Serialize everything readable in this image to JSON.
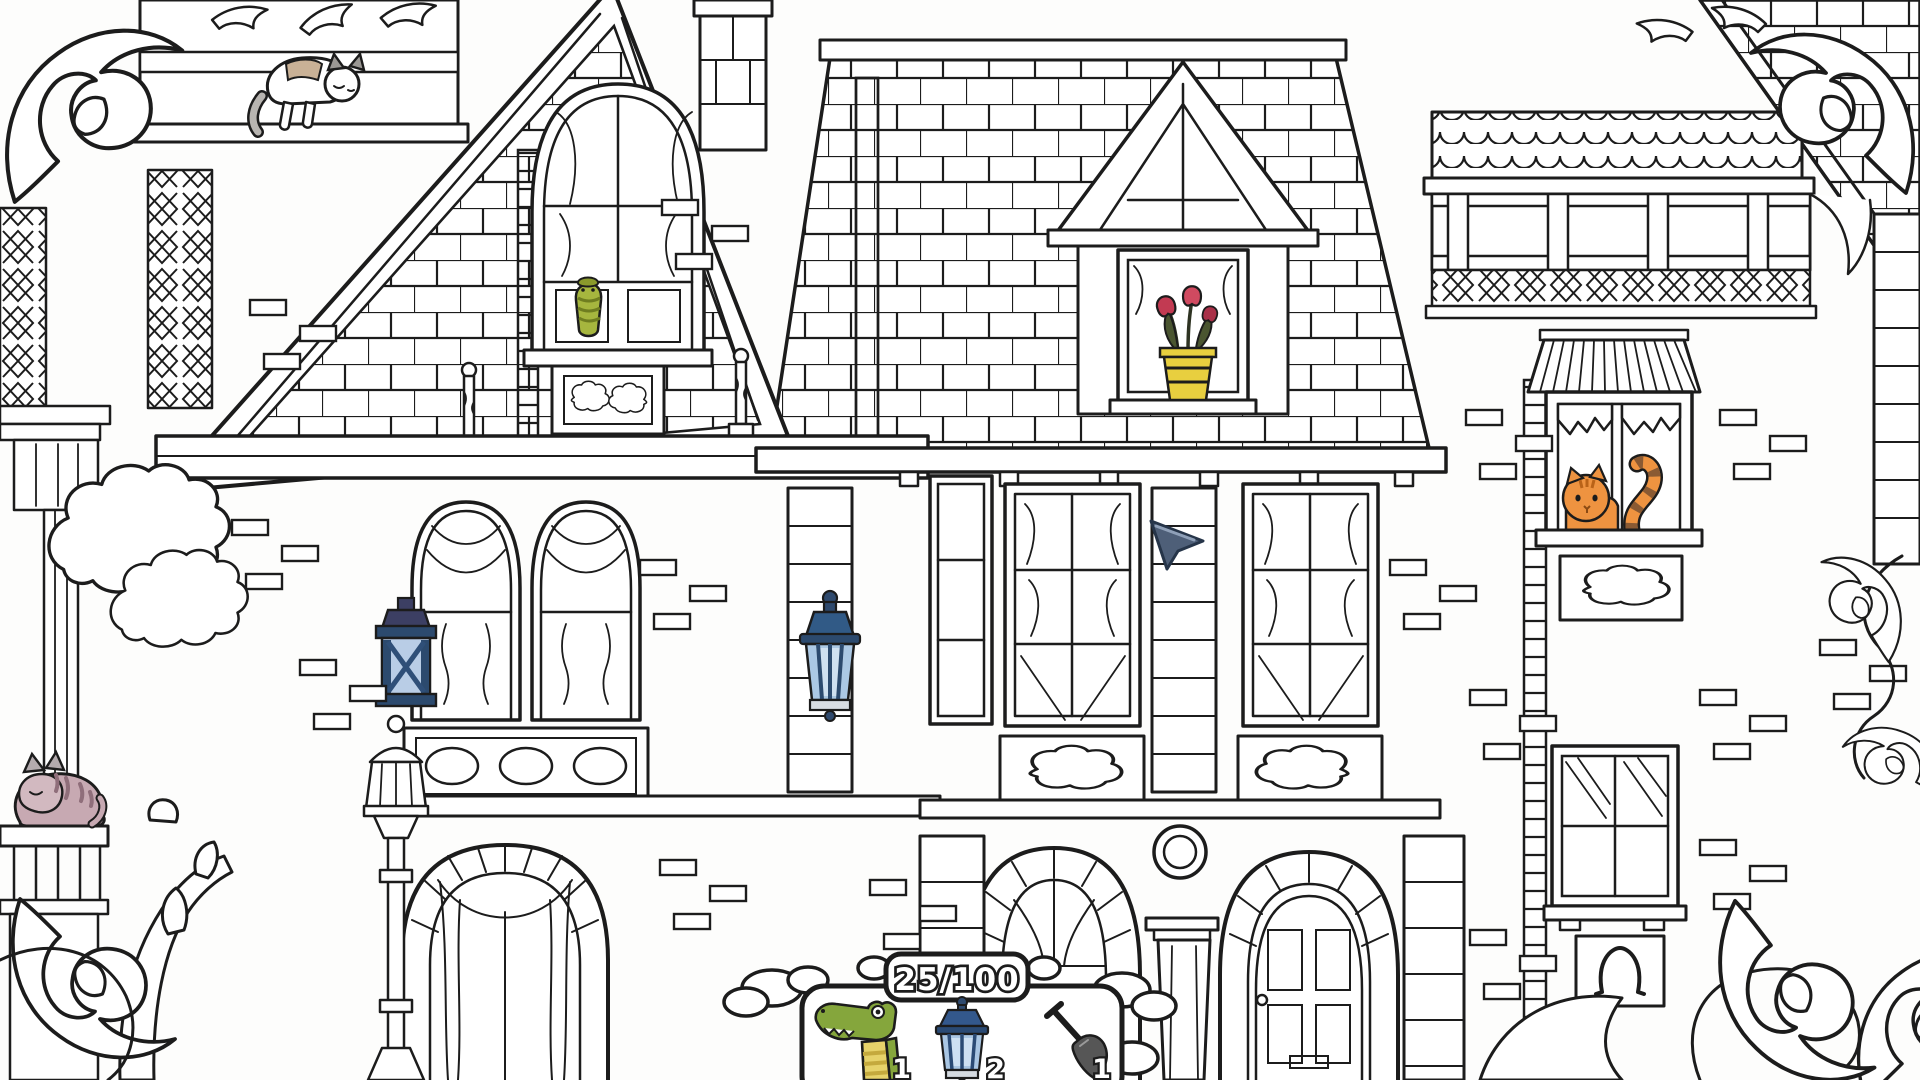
{
  "hud": {
    "counter": "25/100",
    "items": [
      {
        "name": "crocodile",
        "count": "1"
      },
      {
        "name": "lantern",
        "count": "2"
      },
      {
        "name": "shovel",
        "count": "1"
      }
    ]
  },
  "scene": {
    "style": "black-and-white coloring-book line art of an ornate victorian mansion facade",
    "colored_objects": [
      {
        "name": "sleeping-cat-on-ledge",
        "color": "#c7a9b2"
      },
      {
        "name": "cat-on-roof-ridge",
        "color": "#b8b5b1"
      },
      {
        "name": "caterpillar-in-attic-window",
        "color": "#a6b63e"
      },
      {
        "name": "tulips-in-dormer-window",
        "color": "#c23a52"
      },
      {
        "name": "flower-pot",
        "color": "#e8cf3f"
      },
      {
        "name": "square-wall-lantern",
        "color": "#a9c6e3"
      },
      {
        "name": "hanging-wall-lantern",
        "color": "#a9c6e3"
      },
      {
        "name": "orange-cat-in-window",
        "color": "#ee9340"
      }
    ],
    "cursor_color": "#4e5f78",
    "ink_color": "#1c1c1c",
    "paper_color": "#ffffff"
  }
}
